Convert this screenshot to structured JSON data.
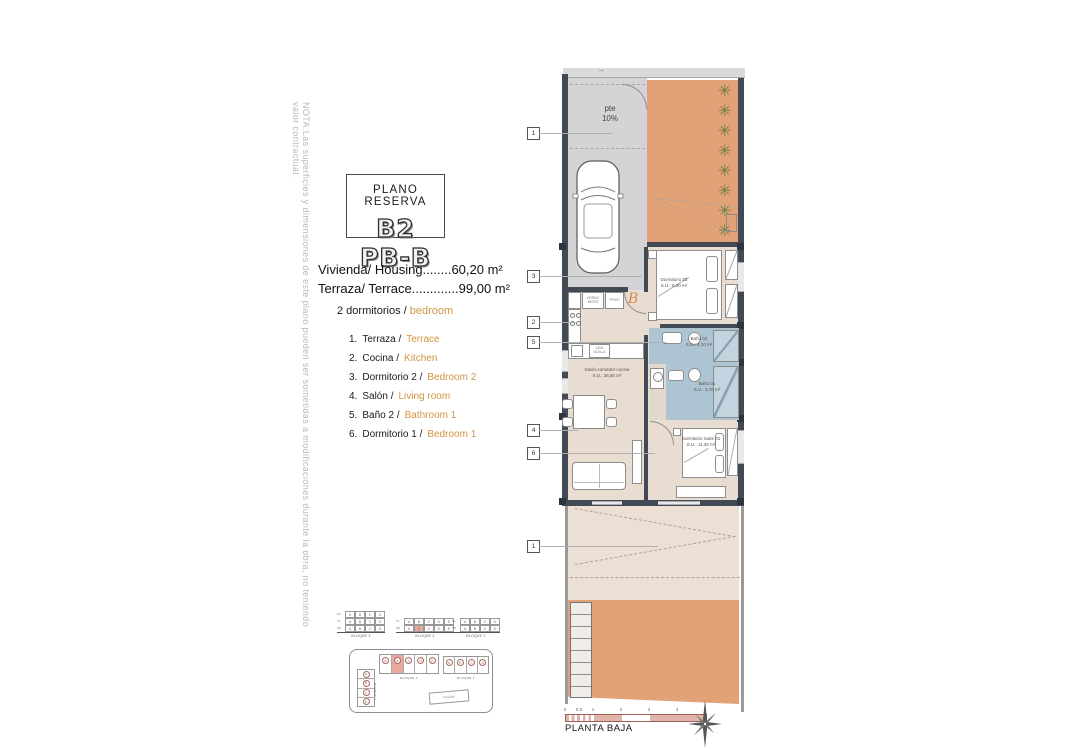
{
  "note": {
    "text": "NOTA:Las superficies y dimensiones de este plano pueden ser sometidas a modificaciones durante la obra, no teniendo valor contractual."
  },
  "title_block": {
    "subtitle": "PLANO RESERVA",
    "unit": "B2 PB-B"
  },
  "areas": {
    "housing": "Vivienda/ Housing........60,20 m²",
    "terrace": "Terraza/ Terrace.............99,00 m²"
  },
  "bedrooms": {
    "es": "2 dormitorios /",
    "en": "bedroom"
  },
  "legend": {
    "items": [
      {
        "num": "1.",
        "es": "Terraza /",
        "en": "Terrace"
      },
      {
        "num": "2.",
        "es": "Cocina /",
        "en": "Kitchen"
      },
      {
        "num": "3.",
        "es": "Dormitorio 2 /",
        "en": "Bedroom 2"
      },
      {
        "num": "4.",
        "es": "Salón /",
        "en": "Living room"
      },
      {
        "num": "5.",
        "es": "Baño 2 /",
        "en": "Bathroom 1"
      },
      {
        "num": "6.",
        "es": "Dormitorio 1 /",
        "en": "Bedroom 1"
      }
    ]
  },
  "plan": {
    "slope": {
      "line1": "pte",
      "line2": "10%"
    },
    "entry_letter": "B",
    "plant_symbol": "✳",
    "arrow_symbol": "→",
    "rooms": {
      "dorm2": {
        "name": "Dormitorio 02",
        "area": "S.U.: 9,30 m²"
      },
      "bath2": {
        "name": "Baño 02",
        "area": "S.U.: 4,10 m²"
      },
      "bath1": {
        "name": "Baño 01",
        "area": "S.U.: 3,70 m²"
      },
      "living": {
        "name": "Salón-comedor-cocina",
        "area": "S.U.: 26,50 m²"
      },
      "suite": {
        "name": "Dormitorio Suite 01",
        "area": "S.U.: 11,20 m²"
      }
    },
    "kitchen": {
      "oven": "HORNO MICRO",
      "fridge": "FRIGO",
      "dishwasher": "LAVA VAJILLA"
    },
    "callouts": [
      "1",
      "3",
      "2",
      "5",
      "4",
      "6",
      "1"
    ]
  },
  "keyplan": {
    "blocks": [
      {
        "caption": "BLOQUE 3",
        "row_labels": [
          "P2",
          "P1",
          "PB"
        ],
        "cols": [
          "A",
          "B",
          "C",
          "D"
        ]
      },
      {
        "caption": "BLOQUE 2",
        "row_labels": [
          "P1",
          "PB"
        ],
        "cols": [
          "A",
          "B",
          "C",
          "D",
          "E"
        ]
      },
      {
        "caption": "BLOQUE 1",
        "row_labels": [
          "P1",
          "PB"
        ],
        "cols": [
          "A",
          "B",
          "C",
          "D"
        ]
      }
    ],
    "site": {
      "bloque2": {
        "caption": "BLOQUE 2",
        "units": [
          "A",
          "B",
          "C",
          "D",
          "E"
        ],
        "highlight": "B"
      },
      "bloque1": {
        "caption": "BLOQUE 1",
        "units": [
          "A",
          "B",
          "C",
          "D"
        ]
      },
      "bloque3": {
        "caption": "BLOQUE 3",
        "units": [
          "A",
          "B",
          "C",
          "D"
        ]
      },
      "pool": "PISCINA"
    }
  },
  "footer": {
    "scale_ticks": [
      "0",
      "0.5",
      "1",
      "2",
      "3",
      "4",
      "5"
    ],
    "plan_name": "PLANTA BAJA"
  },
  "colors": {
    "terrace_orange": "#e2a177",
    "interior_beige": "#e9ddd1",
    "driveway_gray": "#d4d4d6",
    "bath_blue": "#adc4d2",
    "wall_dark": "#424a56",
    "accent_orange": "#d1953f",
    "plant_green": "#6f8040",
    "highlight_salmon": "#eba99e",
    "scalebar_pink": "#e0b4aa"
  }
}
